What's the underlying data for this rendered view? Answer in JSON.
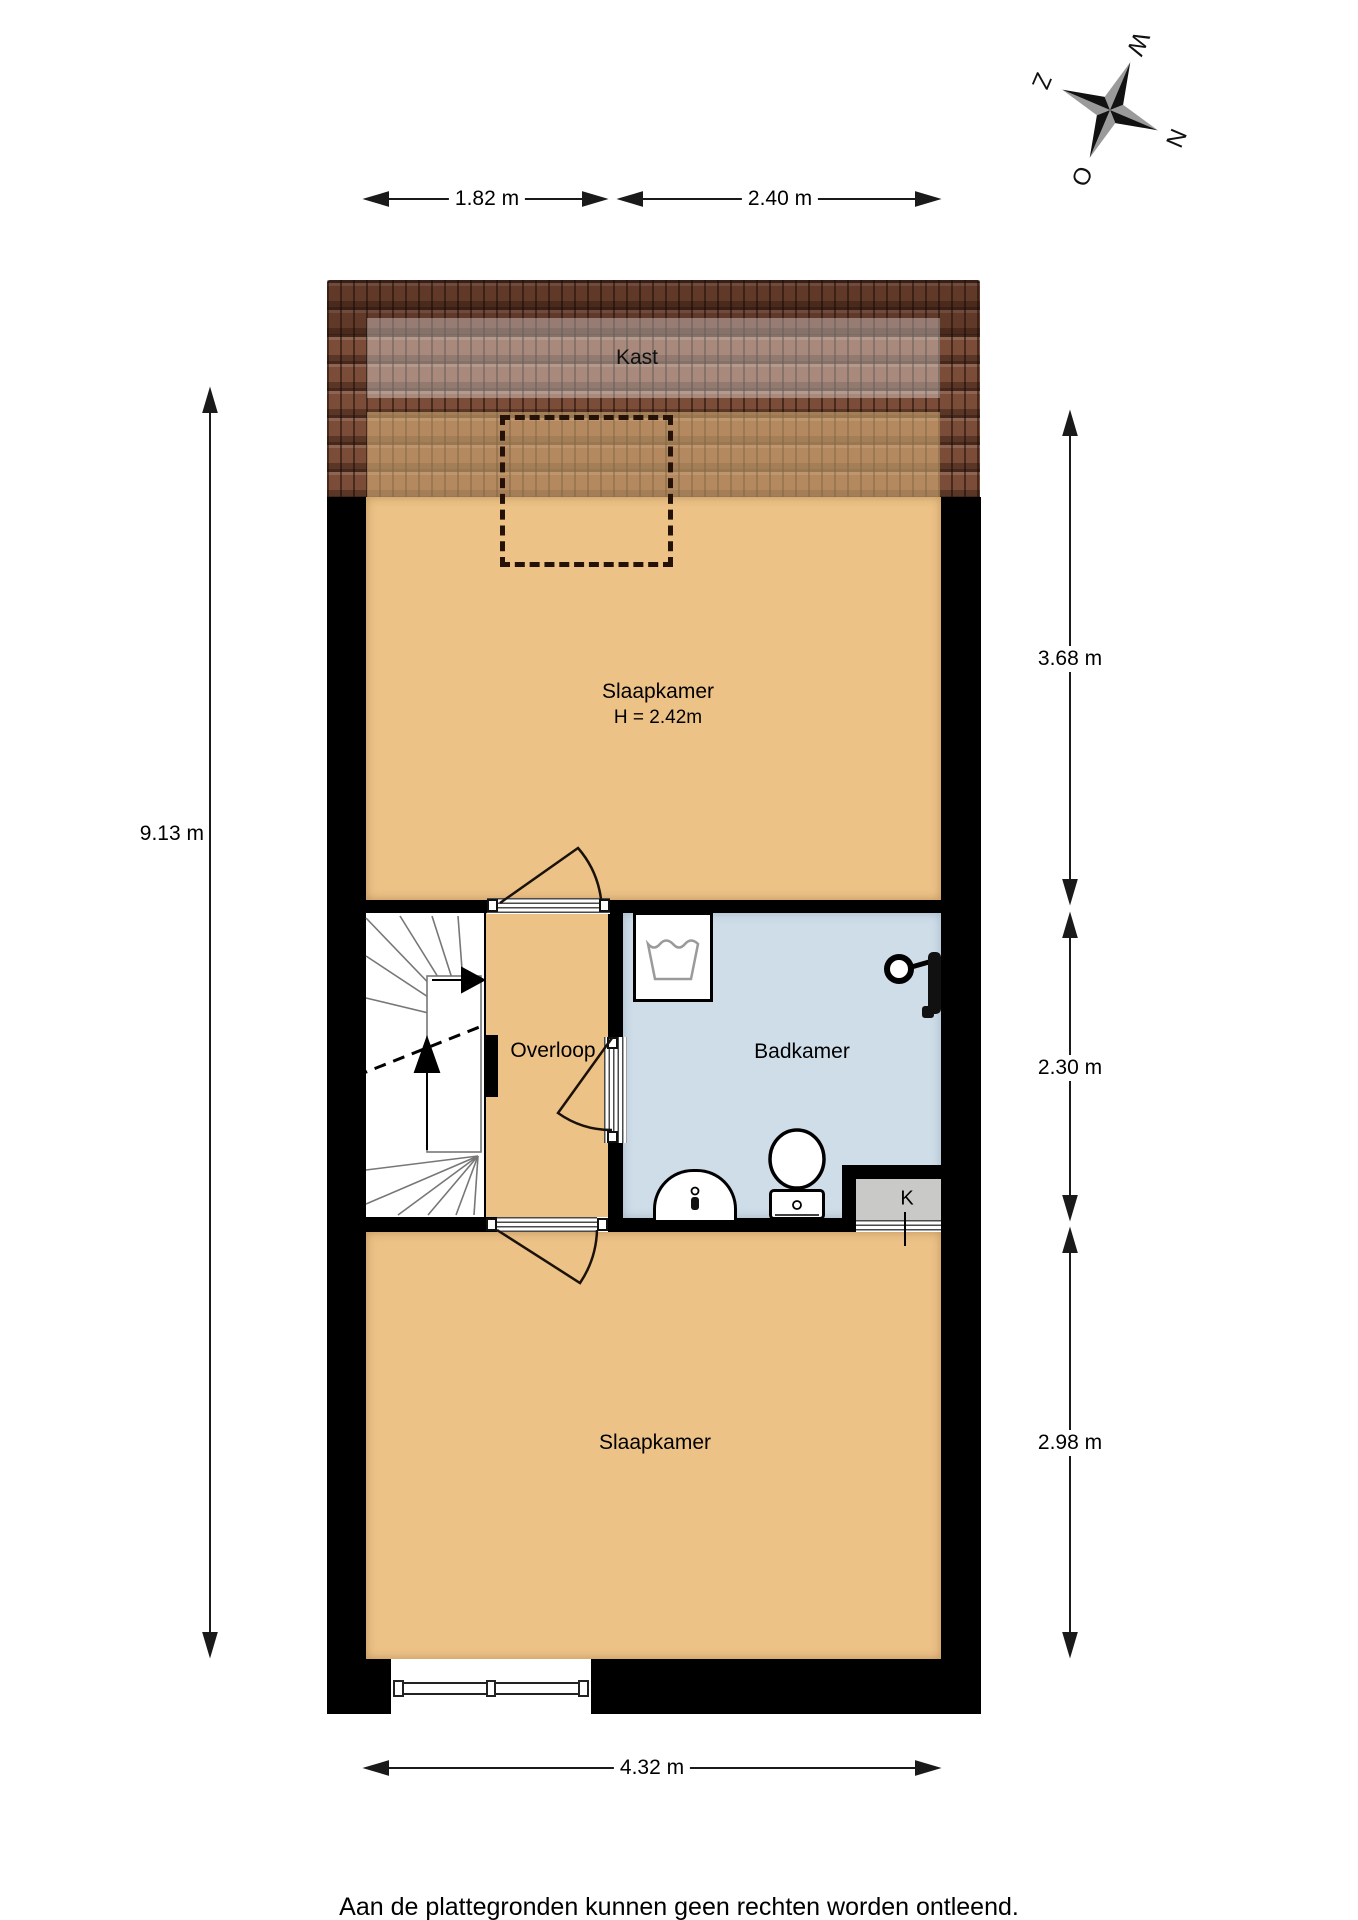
{
  "plan": {
    "rooms": {
      "kast": {
        "label": "Kast"
      },
      "bedroom_top": {
        "label": "Slaapkamer",
        "ceiling_height": "H = 2.42m"
      },
      "overloop": {
        "label": "Overloop"
      },
      "badkamer": {
        "label": "Badkamer"
      },
      "closet_k": {
        "label": "K"
      },
      "bedroom_bottom": {
        "label": "Slaapkamer"
      }
    },
    "fixtures": [
      "stairs",
      "washing-machine",
      "shower",
      "toilet",
      "sink",
      "window",
      "skylight-dashed-outline"
    ],
    "dimensions": {
      "top_left": "1.82 m",
      "top_right": "2.40 m",
      "left": "9.13 m",
      "right_top": "3.68 m",
      "right_middle": "2.30 m",
      "right_bottom": "2.98 m",
      "bottom": "4.32 m"
    },
    "compass": {
      "n": "N",
      "o": "O",
      "z": "Z",
      "w": "W"
    },
    "colors": {
      "floor": "#edc287",
      "bathroom": "#cfdde9",
      "roof": "#7b4c37",
      "wall": "#000000",
      "closet": "#c9c9c7"
    }
  },
  "footer": {
    "disclaimer": "Aan de plattegronden kunnen geen rechten worden ontleend."
  }
}
